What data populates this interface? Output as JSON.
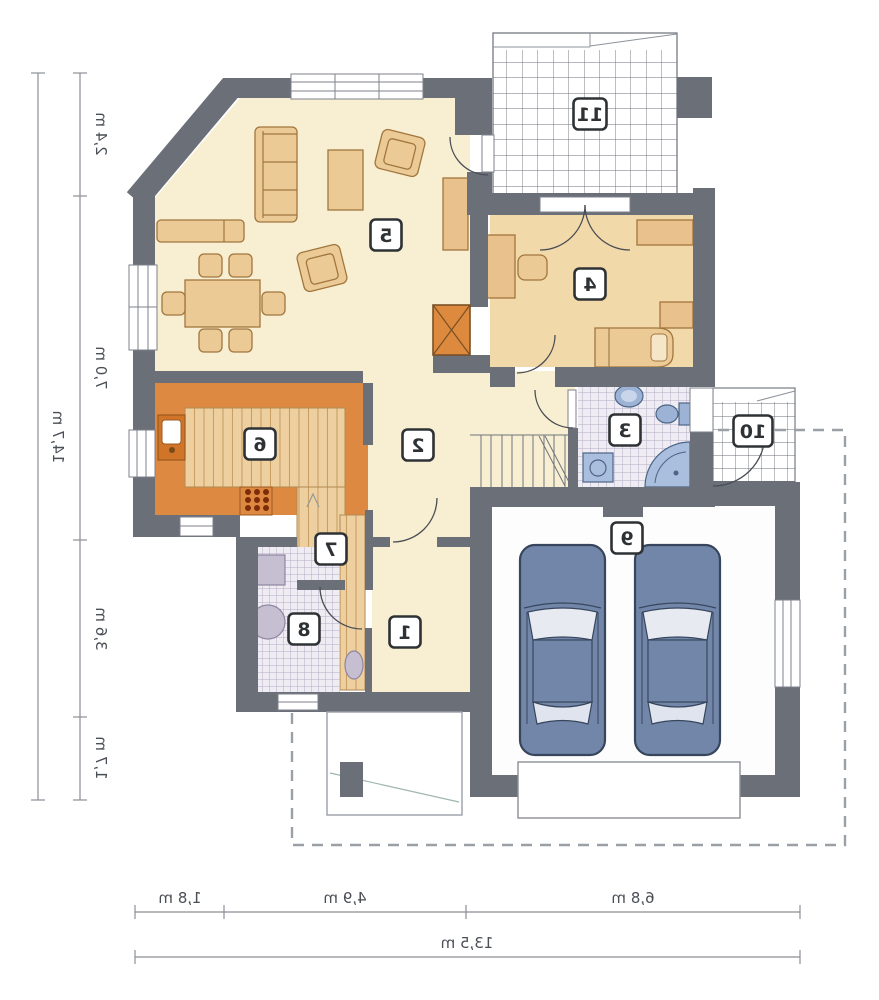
{
  "plan": {
    "type": "residential-floor-plan",
    "mirrored": true,
    "rooms": [
      {
        "number": "1"
      },
      {
        "number": "2"
      },
      {
        "number": "3"
      },
      {
        "number": "4"
      },
      {
        "number": "5"
      },
      {
        "number": "6"
      },
      {
        "number": "7"
      },
      {
        "number": "8"
      },
      {
        "number": "9"
      },
      {
        "number": "10"
      },
      {
        "number": "11"
      }
    ],
    "garage_car_count": 2
  },
  "dimensions": {
    "left_segments": [
      "2,4 m",
      "7,0 m",
      "3,6 m",
      "1,7 m"
    ],
    "left_total": "14,7 m",
    "bottom_segments": [
      "1,8 m",
      "4,9 m",
      "6,8 m"
    ],
    "bottom_total": "13,5 m"
  },
  "colors": {
    "wall": "#6b6f78",
    "floor_cream": "#f8efd3",
    "floor_peach": "#f2d9a9",
    "kitchen_orange": "#dd8942",
    "wood": "#eed0a0",
    "tile_line": "#b6adc4",
    "terrace_line": "#6a6f77",
    "fixture_blue": "#9db3d6",
    "car_blue": "#7186a9",
    "fireplace_orange": "#dd8a3e",
    "dimension_text": "#4a4e55"
  }
}
